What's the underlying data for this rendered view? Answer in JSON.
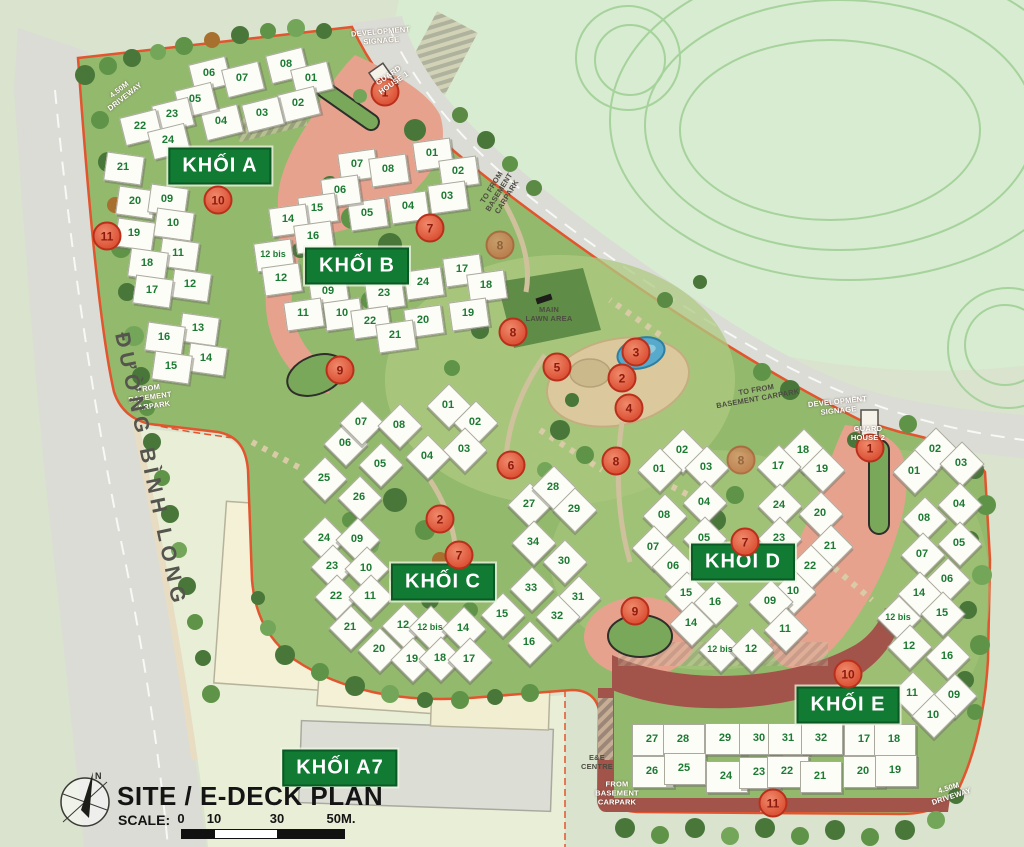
{
  "title": "SITE / E-DECK PLAN",
  "scale": {
    "label": "SCALE:",
    "ticks": [
      {
        "t": "0",
        "x": 181
      },
      {
        "t": "10",
        "x": 214
      },
      {
        "t": "30",
        "x": 277
      },
      {
        "t": "50M.",
        "x": 341
      }
    ]
  },
  "street": "ĐƯỜNG BÌNH LONG",
  "compass": {
    "north": "N"
  },
  "colors": {
    "block_green": "#117a33",
    "marker_red": "#dd5438",
    "boundary_orange": "#e2552e",
    "unit_number_green": "#1c7a33"
  },
  "blocks": [
    {
      "label": "KHỐI A",
      "label_x": 220,
      "label_y": 166,
      "clusters": [
        {
          "angle": -14,
          "w": 36,
          "h": 27,
          "units": [
            {
              "n": "06",
              "x": 209,
              "y": 73
            },
            {
              "n": "07",
              "x": 242,
              "y": 78
            },
            {
              "n": "08",
              "x": 286,
              "y": 64
            },
            {
              "n": "01",
              "x": 311,
              "y": 78
            },
            {
              "n": "02",
              "x": 298,
              "y": 103
            },
            {
              "n": "03",
              "x": 262,
              "y": 113
            },
            {
              "n": "04",
              "x": 221,
              "y": 121
            },
            {
              "n": "05",
              "x": 195,
              "y": 99
            },
            {
              "n": "23",
              "x": 172,
              "y": 114
            },
            {
              "n": "22",
              "x": 140,
              "y": 126
            },
            {
              "n": "24",
              "x": 168,
              "y": 140
            }
          ]
        },
        {
          "angle": 8,
          "w": 36,
          "h": 27,
          "units": [
            {
              "n": "21",
              "x": 123,
              "y": 167
            },
            {
              "n": "20",
              "x": 135,
              "y": 201
            },
            {
              "n": "09",
              "x": 167,
              "y": 199
            },
            {
              "n": "19",
              "x": 134,
              "y": 233
            },
            {
              "n": "10",
              "x": 173,
              "y": 223
            },
            {
              "n": "11",
              "x": 178,
              "y": 253
            },
            {
              "n": "18",
              "x": 147,
              "y": 263
            },
            {
              "n": "12",
              "x": 190,
              "y": 284
            },
            {
              "n": "17",
              "x": 152,
              "y": 290
            },
            {
              "n": "13",
              "x": 198,
              "y": 328
            },
            {
              "n": "16",
              "x": 164,
              "y": 337
            },
            {
              "n": "14",
              "x": 206,
              "y": 358
            },
            {
              "n": "15",
              "x": 171,
              "y": 366
            }
          ]
        }
      ]
    },
    {
      "label": "KHỐI B",
      "label_x": 357,
      "label_y": 266,
      "clusters": [
        {
          "angle": -8,
          "w": 36,
          "h": 27,
          "units": [
            {
              "n": "07",
              "x": 357,
              "y": 164
            },
            {
              "n": "08",
              "x": 388,
              "y": 169
            },
            {
              "n": "01",
              "x": 432,
              "y": 153
            },
            {
              "n": "02",
              "x": 458,
              "y": 171
            },
            {
              "n": "03",
              "x": 447,
              "y": 196
            },
            {
              "n": "04",
              "x": 408,
              "y": 206
            },
            {
              "n": "05",
              "x": 367,
              "y": 213
            },
            {
              "n": "06",
              "x": 340,
              "y": 190
            },
            {
              "n": "15",
              "x": 317,
              "y": 208
            },
            {
              "n": "14",
              "x": 288,
              "y": 219
            },
            {
              "n": "16",
              "x": 313,
              "y": 236
            },
            {
              "n": "12 bis",
              "x": 273,
              "y": 254
            },
            {
              "n": "12",
              "x": 281,
              "y": 278
            },
            {
              "n": "09",
              "x": 328,
              "y": 291
            },
            {
              "n": "10",
              "x": 342,
              "y": 313
            },
            {
              "n": "11",
              "x": 303,
              "y": 313
            },
            {
              "n": "17",
              "x": 462,
              "y": 269
            },
            {
              "n": "18",
              "x": 486,
              "y": 285
            },
            {
              "n": "24",
              "x": 423,
              "y": 282
            },
            {
              "n": "23",
              "x": 384,
              "y": 293
            },
            {
              "n": "19",
              "x": 468,
              "y": 313
            },
            {
              "n": "20",
              "x": 423,
              "y": 320
            },
            {
              "n": "22",
              "x": 370,
              "y": 321
            },
            {
              "n": "21",
              "x": 395,
              "y": 335
            }
          ]
        }
      ]
    },
    {
      "label": "KHỐI C",
      "label_x": 443,
      "label_y": 582,
      "clusters": [
        {
          "angle": 45,
          "w": 30,
          "h": 30,
          "units": [
            {
              "n": "01",
              "x": 448,
              "y": 405
            },
            {
              "n": "02",
              "x": 475,
              "y": 422
            },
            {
              "n": "03",
              "x": 464,
              "y": 449
            },
            {
              "n": "04",
              "x": 427,
              "y": 456
            },
            {
              "n": "05",
              "x": 380,
              "y": 464
            },
            {
              "n": "06",
              "x": 345,
              "y": 443
            },
            {
              "n": "07",
              "x": 361,
              "y": 422
            },
            {
              "n": "08",
              "x": 399,
              "y": 425
            },
            {
              "n": "25",
              "x": 324,
              "y": 478
            },
            {
              "n": "26",
              "x": 359,
              "y": 497
            },
            {
              "n": "24",
              "x": 324,
              "y": 538
            },
            {
              "n": "09",
              "x": 357,
              "y": 539
            },
            {
              "n": "23",
              "x": 332,
              "y": 566
            },
            {
              "n": "10",
              "x": 366,
              "y": 568
            },
            {
              "n": "22",
              "x": 336,
              "y": 596
            },
            {
              "n": "11",
              "x": 370,
              "y": 596
            },
            {
              "n": "21",
              "x": 350,
              "y": 627
            },
            {
              "n": "12",
              "x": 403,
              "y": 625
            },
            {
              "n": "12 bis",
              "x": 430,
              "y": 627
            },
            {
              "n": "14",
              "x": 463,
              "y": 628
            },
            {
              "n": "20",
              "x": 379,
              "y": 649
            },
            {
              "n": "19",
              "x": 412,
              "y": 659
            },
            {
              "n": "18",
              "x": 440,
              "y": 658
            },
            {
              "n": "17",
              "x": 469,
              "y": 659
            },
            {
              "n": "15",
              "x": 502,
              "y": 614
            },
            {
              "n": "16",
              "x": 529,
              "y": 642
            },
            {
              "n": "27",
              "x": 529,
              "y": 504
            },
            {
              "n": "28",
              "x": 553,
              "y": 487
            },
            {
              "n": "29",
              "x": 574,
              "y": 509
            },
            {
              "n": "34",
              "x": 533,
              "y": 542
            },
            {
              "n": "30",
              "x": 564,
              "y": 561
            },
            {
              "n": "33",
              "x": 531,
              "y": 588
            },
            {
              "n": "31",
              "x": 578,
              "y": 597
            },
            {
              "n": "32",
              "x": 557,
              "y": 616
            }
          ]
        }
      ]
    },
    {
      "label": "KHỐI D",
      "label_x": 743,
      "label_y": 562,
      "clusters": [
        {
          "angle": 45,
          "w": 30,
          "h": 30,
          "units": [
            {
              "n": "02",
              "x": 682,
              "y": 450
            },
            {
              "n": "01",
              "x": 659,
              "y": 469
            },
            {
              "n": "03",
              "x": 706,
              "y": 467
            },
            {
              "n": "04",
              "x": 704,
              "y": 502
            },
            {
              "n": "08",
              "x": 664,
              "y": 515
            },
            {
              "n": "05",
              "x": 704,
              "y": 538
            },
            {
              "n": "07",
              "x": 653,
              "y": 547
            },
            {
              "n": "06",
              "x": 673,
              "y": 566
            },
            {
              "n": "15",
              "x": 686,
              "y": 593
            },
            {
              "n": "16",
              "x": 715,
              "y": 602
            },
            {
              "n": "14",
              "x": 691,
              "y": 623
            },
            {
              "n": "18",
              "x": 803,
              "y": 450
            },
            {
              "n": "17",
              "x": 778,
              "y": 466
            },
            {
              "n": "19",
              "x": 822,
              "y": 469
            },
            {
              "n": "24",
              "x": 779,
              "y": 505
            },
            {
              "n": "20",
              "x": 820,
              "y": 513
            },
            {
              "n": "23",
              "x": 779,
              "y": 538
            },
            {
              "n": "21",
              "x": 830,
              "y": 546
            },
            {
              "n": "22",
              "x": 810,
              "y": 566
            },
            {
              "n": "10",
              "x": 793,
              "y": 591
            },
            {
              "n": "09",
              "x": 770,
              "y": 601
            },
            {
              "n": "11",
              "x": 785,
              "y": 629
            },
            {
              "n": "12 bis",
              "x": 720,
              "y": 649
            },
            {
              "n": "12",
              "x": 751,
              "y": 649
            }
          ]
        }
      ]
    },
    {
      "label": "KHỐI E",
      "label_x": 848,
      "label_y": 705,
      "clusters": [
        {
          "angle": 45,
          "w": 30,
          "h": 30,
          "units": [
            {
              "n": "02",
              "x": 935,
              "y": 449
            },
            {
              "n": "03",
              "x": 961,
              "y": 463
            },
            {
              "n": "01",
              "x": 914,
              "y": 471
            },
            {
              "n": "04",
              "x": 959,
              "y": 504
            },
            {
              "n": "08",
              "x": 924,
              "y": 518
            },
            {
              "n": "05",
              "x": 959,
              "y": 543
            },
            {
              "n": "07",
              "x": 922,
              "y": 554
            },
            {
              "n": "06",
              "x": 947,
              "y": 579
            },
            {
              "n": "14",
              "x": 919,
              "y": 593
            },
            {
              "n": "15",
              "x": 942,
              "y": 613
            },
            {
              "n": "12 bis",
              "x": 898,
              "y": 617
            },
            {
              "n": "12",
              "x": 909,
              "y": 646
            },
            {
              "n": "16",
              "x": 947,
              "y": 656
            },
            {
              "n": "11",
              "x": 912,
              "y": 693
            },
            {
              "n": "09",
              "x": 954,
              "y": 695
            },
            {
              "n": "10",
              "x": 933,
              "y": 715
            }
          ]
        },
        {
          "angle": 0,
          "w": 40,
          "h": 30,
          "units": [
            {
              "n": "27",
              "x": 652,
              "y": 739
            },
            {
              "n": "28",
              "x": 683,
              "y": 739
            },
            {
              "n": "29",
              "x": 725,
              "y": 738
            },
            {
              "n": "30",
              "x": 759,
              "y": 738
            },
            {
              "n": "31",
              "x": 788,
              "y": 738
            },
            {
              "n": "32",
              "x": 821,
              "y": 738
            },
            {
              "n": "17",
              "x": 864,
              "y": 739
            },
            {
              "n": "18",
              "x": 894,
              "y": 739
            },
            {
              "n": "26",
              "x": 652,
              "y": 771
            },
            {
              "n": "25",
              "x": 684,
              "y": 768
            },
            {
              "n": "24",
              "x": 726,
              "y": 776
            },
            {
              "n": "23",
              "x": 759,
              "y": 772
            },
            {
              "n": "22",
              "x": 787,
              "y": 771
            },
            {
              "n": "21",
              "x": 820,
              "y": 776
            },
            {
              "n": "20",
              "x": 863,
              "y": 771
            },
            {
              "n": "19",
              "x": 895,
              "y": 770
            }
          ]
        }
      ]
    },
    {
      "label": "KHỐI A7",
      "label_x": 340,
      "label_y": 768,
      "clusters": []
    }
  ],
  "markers": [
    {
      "n": "1",
      "x": 385,
      "y": 92
    },
    {
      "n": "1",
      "x": 870,
      "y": 448
    },
    {
      "n": "2",
      "x": 622,
      "y": 378
    },
    {
      "n": "2",
      "x": 440,
      "y": 519
    },
    {
      "n": "3",
      "x": 636,
      "y": 352
    },
    {
      "n": "4",
      "x": 629,
      "y": 408
    },
    {
      "n": "5",
      "x": 557,
      "y": 367
    },
    {
      "n": "6",
      "x": 511,
      "y": 465
    },
    {
      "n": "7",
      "x": 430,
      "y": 228
    },
    {
      "n": "7",
      "x": 745,
      "y": 542
    },
    {
      "n": "7",
      "x": 459,
      "y": 555
    },
    {
      "n": "8",
      "x": 513,
      "y": 332
    },
    {
      "n": "8",
      "x": 500,
      "y": 245,
      "faded": true
    },
    {
      "n": "8",
      "x": 616,
      "y": 461
    },
    {
      "n": "8",
      "x": 741,
      "y": 460,
      "faded": true
    },
    {
      "n": "9",
      "x": 340,
      "y": 370
    },
    {
      "n": "9",
      "x": 635,
      "y": 611
    },
    {
      "n": "10",
      "x": 218,
      "y": 200
    },
    {
      "n": "10",
      "x": 848,
      "y": 674
    },
    {
      "n": "11",
      "x": 107,
      "y": 236
    },
    {
      "n": "11",
      "x": 773,
      "y": 803
    }
  ],
  "annotations": [
    {
      "text": "DEVELOPMENT\nSIGNAGE",
      "x": 381,
      "y": 36,
      "cls": "light",
      "rot": -5
    },
    {
      "text": "GUARD\nHOUSE 1",
      "x": 391,
      "y": 79,
      "cls": "light",
      "rot": -35
    },
    {
      "text": "4.50M\nDRIVEWAY",
      "x": 122,
      "y": 93,
      "cls": "light",
      "rot": -38
    },
    {
      "text": "TO FROM\nBASEMENT\nCARPARK",
      "x": 499,
      "y": 192,
      "cls": "dark",
      "rot": -58
    },
    {
      "text": "FROM\nBASEMENT\nCARPARK",
      "x": 150,
      "y": 397,
      "cls": "light",
      "rot": -8
    },
    {
      "text": "MAIN\nLAWN AREA",
      "x": 549,
      "y": 314,
      "cls": "dark",
      "rot": 0
    },
    {
      "text": "TO FROM\nBASEMENT CARPARK",
      "x": 757,
      "y": 394,
      "cls": "dark",
      "rot": -10
    },
    {
      "text": "DEVELOPMENT\nSIGNAGE",
      "x": 838,
      "y": 406,
      "cls": "light",
      "rot": -6
    },
    {
      "text": "GUARD\nHOUSE 2",
      "x": 868,
      "y": 433,
      "cls": "light",
      "rot": 0
    },
    {
      "text": "E&E\nCENTRE",
      "x": 597,
      "y": 762,
      "cls": "dark",
      "rot": 0
    },
    {
      "text": "FROM\nBASEMENT\nCARPARK",
      "x": 617,
      "y": 793,
      "cls": "light",
      "rot": 0
    },
    {
      "text": "4.50M\nDRIVEWAY",
      "x": 950,
      "y": 792,
      "cls": "light",
      "rot": -18
    }
  ]
}
